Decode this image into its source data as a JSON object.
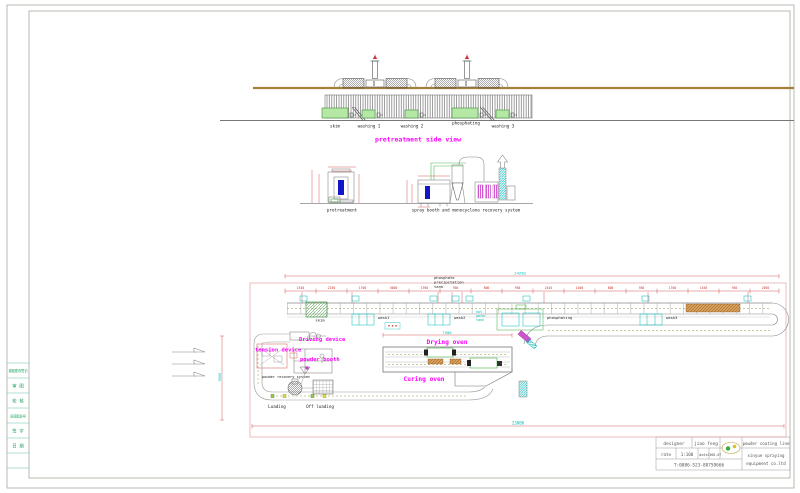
{
  "drawing": {
    "side_view": {
      "title": "pretreatment side view",
      "tank_labels": [
        "skim",
        "washing 1",
        "washing 2",
        "phosphating",
        "washing 3"
      ]
    },
    "front_views": {
      "pretreatment_label": "pretreatment",
      "booth_label": "spray booth and monocyclone recovery system"
    },
    "plan_view": {
      "note_lines": [
        "phosphate",
        "precipitation",
        "tank"
      ],
      "labels": {
        "driving_device": "Driving device",
        "tension_device": "tension device",
        "powder_booth": "powder booth",
        "powder_recovery": "powder recovery system",
        "drying_oven": "Drying oven",
        "curing_oven": "Curing oven",
        "loading": "Loading",
        "off_loading": "Off loading",
        "skim": "skim",
        "wash1": "wash1",
        "wash2": "wash2",
        "wash3": "wash3",
        "phosphating": "phosphating",
        "hot_water_tank_lines": [
          "hot",
          "water",
          "tank"
        ]
      },
      "dims": {
        "total_top": "24250",
        "total_bottom": "23000",
        "oven_length": "7500",
        "left_height": "9000",
        "segments": [
          "1540",
          "2250",
          "1700",
          "3000",
          "1950",
          "950",
          "800",
          "950",
          "2445",
          "1400",
          "800",
          "950",
          "1700",
          "1450",
          "950",
          "2050"
        ]
      }
    }
  },
  "left_strip": {
    "rows": [
      "描图更改签记",
      "审 图",
      "校 核",
      "旧底图总号",
      "签 字",
      "日 期"
    ]
  },
  "title_block": {
    "designer_label": "designer",
    "designer_value": "jiao feng",
    "rate_label": "rate",
    "rate_value": "1:100",
    "date_label": "date",
    "date_value": "2005.07",
    "phone": "T:0086-523-88759666",
    "project": "powder coating line",
    "company_lines": [
      "xinyue spraying",
      "equipment co.ltd"
    ]
  },
  "colors": {
    "accent_magenta": "#ff00ff",
    "dim_red": "#cc3333",
    "cyan": "#00b8b8",
    "tank_green": "#b5e8a5",
    "roof_tan": "#a5803a",
    "booth_blue": "#1515c8"
  }
}
